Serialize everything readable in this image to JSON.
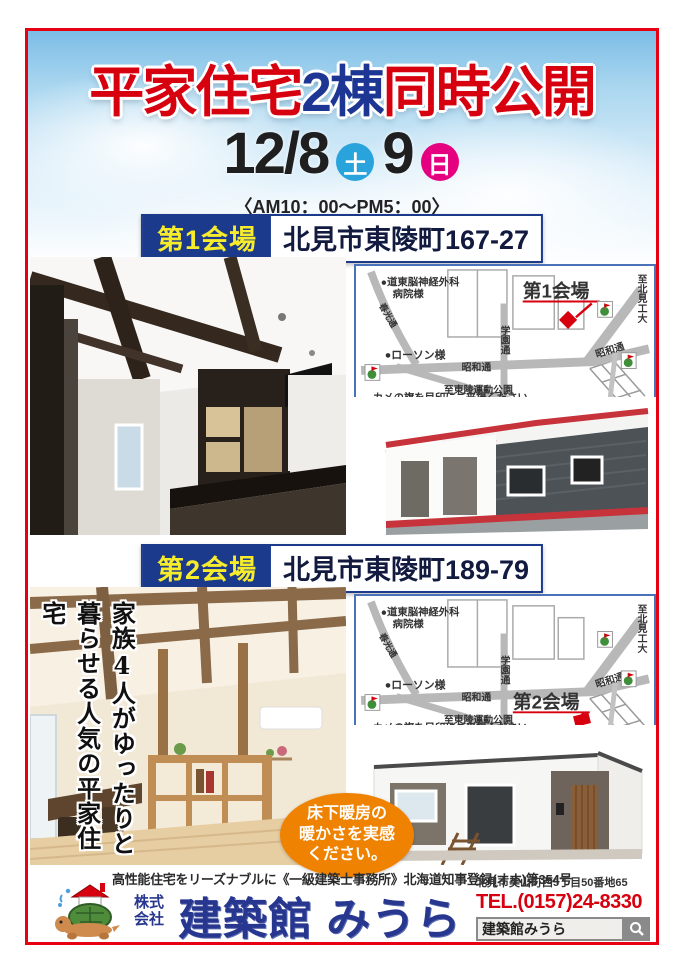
{
  "header": {
    "title": {
      "part1": "平家住宅",
      "part2": "2棟",
      "part3": "同時公開"
    },
    "date": {
      "main": "12/8",
      "day1": "土",
      "second": "9",
      "day2": "日"
    },
    "time": "〈AM10：00〜PM5：00〉"
  },
  "venues": {
    "v1": {
      "label": "第1会場",
      "address": "北見市東陵町167-27"
    },
    "v2": {
      "label": "第2会場",
      "address": "北見市東陵町189-79"
    }
  },
  "map": {
    "hospital_line1": "●道東脳神経外科",
    "hospital_line2": "病院様",
    "lawson": "●ローソン様",
    "road_showa": "昭和通",
    "road_showa_2": "昭和通",
    "road_gakuen": "学園通",
    "road_side": "春光通",
    "to_park": "至東陵運動公園",
    "to_univ": "至北見工大",
    "note": "カメの旗を目印にご来場ください。",
    "venue1": "第1会場",
    "venue2": "第2会場"
  },
  "overlay": {
    "col1": "家族4人がゆったりと",
    "col2": "暮らせる人気の平家住宅"
  },
  "badge": {
    "line1": "床下暖房の",
    "line2": "暖かさを実感",
    "line3": "ください。"
  },
  "footer": {
    "tagline": "高性能住宅をリーズナブルに《一級建築士事務所》北海道知事登録(オホ)第354号",
    "company_type_1": "株式",
    "company_type_2": "会社",
    "company_name": "建築館 みうら",
    "address": "北見市美山町西5丁目50番地65",
    "tel": "TEL.(0157)24-8330",
    "search_value": "建築館みうら"
  },
  "colors": {
    "frame_red": "#e60012",
    "title_red": "#d7000f",
    "title_blue": "#1d3693",
    "banner_navy": "#1b3a8c",
    "banner_yellow": "#f7ec2c",
    "sat_blue": "#29a3dc",
    "sun_pink": "#e4007f",
    "badge_orange": "#ef8200",
    "logo_navy": "#27368f",
    "tel_red": "#d7000f"
  }
}
